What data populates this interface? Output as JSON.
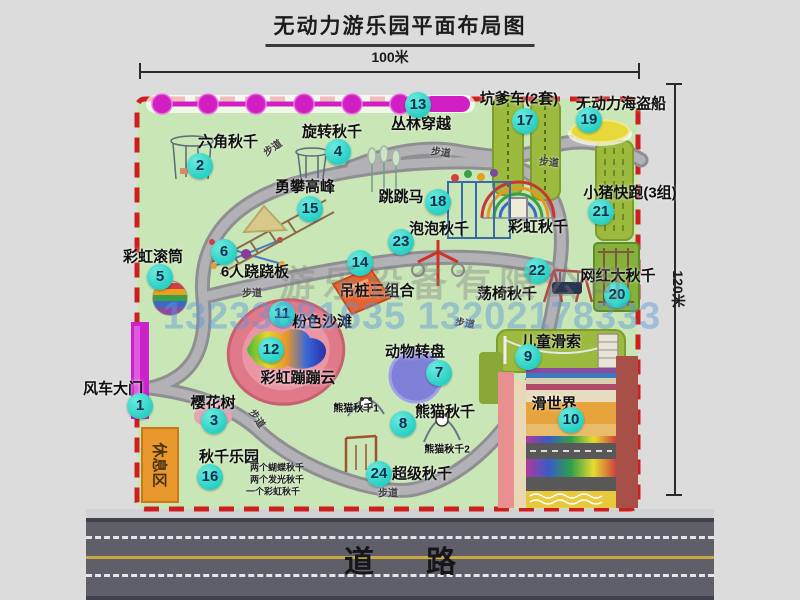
{
  "title": "无动力游乐园平面布局图",
  "dimensions": {
    "width": "100米",
    "height": "120米"
  },
  "road": {
    "label": "道路"
  },
  "watermark": {
    "company": "游乐设备有限公司",
    "phone": "13233881635 13202178333"
  },
  "annotations": {
    "rainbow_swing": "彩虹秋千",
    "panda_swing_1": "熊猫秋千1",
    "panda_swing_2": "熊猫秋千2",
    "swing_park_items": [
      "两个蝴蝶秋千",
      "两个发光秋千",
      "一个彩虹秋千"
    ],
    "rest_area": "休息区",
    "walkway": "步道"
  },
  "attractions": [
    {
      "num": "1",
      "label": "风车大门"
    },
    {
      "num": "2",
      "label": "六角秋千"
    },
    {
      "num": "3",
      "label": "樱花树"
    },
    {
      "num": "4",
      "label": "旋转秋千"
    },
    {
      "num": "5",
      "label": "彩虹滚筒"
    },
    {
      "num": "6",
      "label": "6人跷跷板"
    },
    {
      "num": "7",
      "label": "动物转盘"
    },
    {
      "num": "8",
      "label": "熊猫秋千"
    },
    {
      "num": "9",
      "label": "儿童滑索"
    },
    {
      "num": "10",
      "label": "滑世界"
    },
    {
      "num": "11",
      "label": "粉色沙滩"
    },
    {
      "num": "12",
      "label": "彩虹蹦蹦云"
    },
    {
      "num": "13",
      "label": "丛林穿越"
    },
    {
      "num": "14",
      "label": "吊桩三组合"
    },
    {
      "num": "15",
      "label": "勇攀高峰"
    },
    {
      "num": "16",
      "label": "秋千乐园"
    },
    {
      "num": "17",
      "label": "坑爹车(2套)"
    },
    {
      "num": "18",
      "label": "跳跳马"
    },
    {
      "num": "19",
      "label": "无动力海盗船"
    },
    {
      "num": "20",
      "label": "网红大秋千"
    },
    {
      "num": "21",
      "label": "小猪快跑(3组)"
    },
    {
      "num": "22",
      "label": "荡椅秋千"
    },
    {
      "num": "23",
      "label": "泡泡秋千"
    },
    {
      "num": "24",
      "label": "超级秋千"
    }
  ],
  "colors": {
    "park_green": "#c9e6b6",
    "border_red": "#ce1f1f",
    "badge_teal": "#35dfd3",
    "chain_magenta": "#d21fc4",
    "gate_magenta": "#cc22cc",
    "rest_orange": "#e8982c",
    "road_gray": "#5f5f69",
    "watermark_blue": "#5a96dc"
  }
}
